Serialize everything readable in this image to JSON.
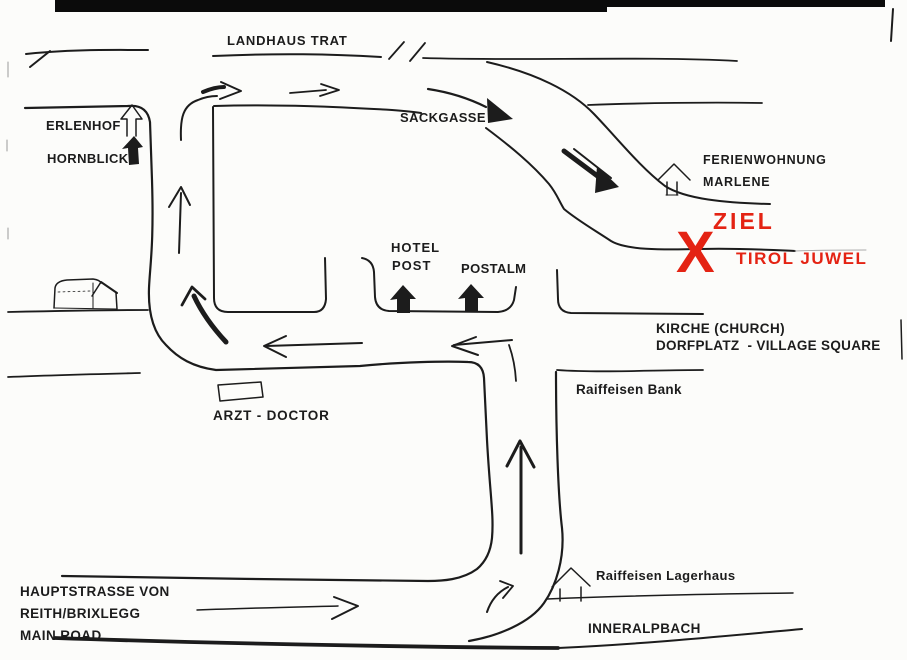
{
  "document": {
    "kind": "hand-drawn directions map (scanned)",
    "destination": "TIROL JUWEL"
  },
  "colors": {
    "ink": "#1c1c1c",
    "goal_red": "#e42313",
    "paper": "#fcfcfa"
  },
  "labels": {
    "landhaus_trat": "LANDHAUS TRAT",
    "erlenhof": "ERLENHOF",
    "hornblick": "HORNBLICK",
    "sackgasse": "SACKGASSE",
    "ferienwohnung_line1": "FERIENWOHNUNG",
    "ferienwohnung_line2": "MARLENE",
    "ziel": "ZIEL",
    "x_mark": "X",
    "tirol_juwel": "TIROL JUWEL",
    "hotel_line1": "HOTEL",
    "hotel_line2": "POST",
    "postalm": "POSTALM",
    "kirche": "KIRCHE (CHURCH)",
    "dorfplatz": "DORFPLATZ  - VILLAGE SQUARE",
    "raiffeisen_bank": "Raiffeisen Bank",
    "arzt": "ARZT - DOCTOR",
    "hauptstrasse_line1": "HAUPTSTRASSE VON",
    "hauptstrasse_line2": "REITH/BRIXLEGG",
    "hauptstrasse_line3": "MAIN ROAD",
    "raiffeisen_lagerhaus": "Raiffeisen Lagerhaus",
    "inneralpbach": "INNERALPBACH"
  },
  "icons": {
    "erlenhof": "house-outline-icon",
    "hornblick": "house-filled-icon",
    "hotel_post": "house-filled-icon",
    "postalm": "house-filled-icon",
    "ferienwohnung_marlene": "house-outline-icon",
    "raiffeisen_lagerhaus": "house-outline-icon",
    "farm_building": "barn-icon",
    "goal": "x-cross-marker"
  }
}
